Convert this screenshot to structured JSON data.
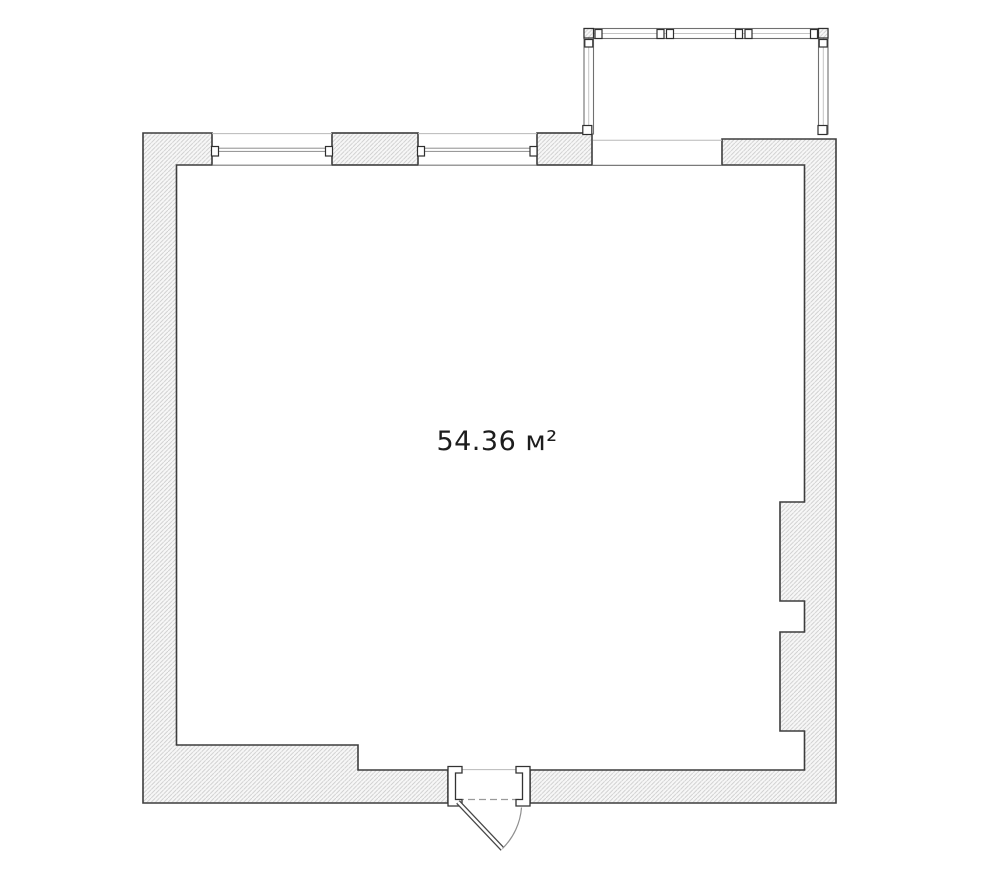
{
  "floor_plan": {
    "area_label": "54.36 м²"
  },
  "colors": {
    "background": "#ffffff",
    "wall_outline": "#3d3d3d",
    "hatch_line": "#cccccc",
    "hatch_background": "#f7f7f7",
    "glazing_frame": "#707070",
    "label_text": "#1d1d1d"
  }
}
